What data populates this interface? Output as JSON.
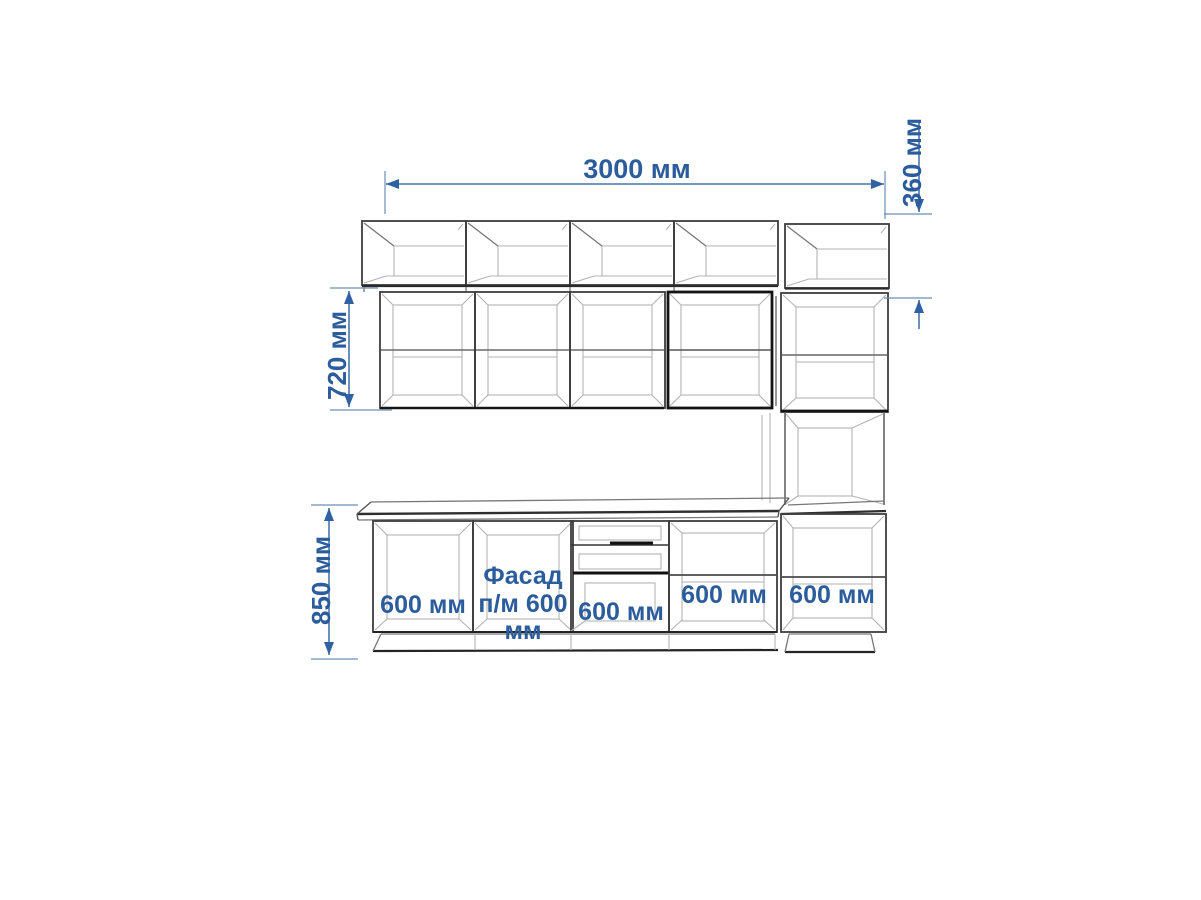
{
  "drawing": {
    "type": "kitchen-cabinet-elevation",
    "dimensions": {
      "total_width": "3000 мм",
      "upper_row_height": "360 мм",
      "wall_row_height": "720 мм",
      "base_row_height": "850 мм"
    },
    "base_cabinet_labels": {
      "cabinet_1": "600 мм",
      "sink_facade_line_1": "Фасад",
      "sink_facade_line_2": "п/м 600",
      "sink_facade_line_3": "мм",
      "cabinet_3": "600 мм",
      "cabinet_4": "600 мм",
      "tall_column_base": "600 мм"
    },
    "colors": {
      "dimension_blue": "#2b5c9c",
      "line_dark": "#3d3d3d",
      "line_heavy": "#161616",
      "line_light": "#b3b3b3",
      "background": "#ffffff"
    }
  }
}
